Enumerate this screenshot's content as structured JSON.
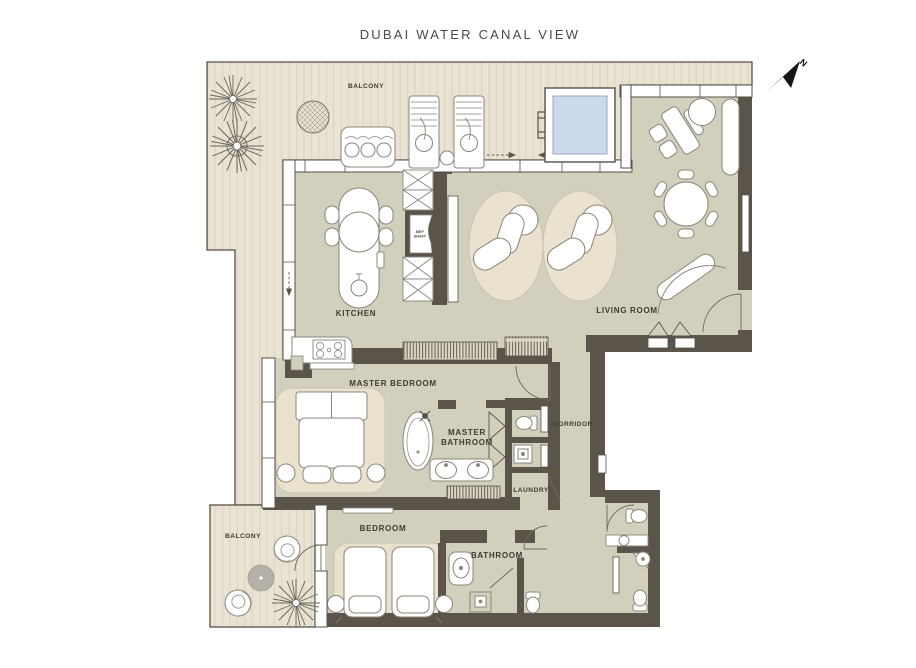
{
  "header": {
    "title": "DUBAI WATER CANAL VIEW"
  },
  "compass": {
    "n": "N"
  },
  "rooms": {
    "balcony_top": "BALCONY",
    "balcony_bottom": "BALCONY",
    "kitchen": "KITCHEN",
    "living_room": "LIVING ROOM",
    "master_bedroom": "MASTER BEDROOM",
    "master_bathroom_line1": "MASTER",
    "master_bathroom_line2": "BATHROOM",
    "corridor": "CORRIDOR",
    "laundry": "LAUNDRY",
    "bedroom": "BEDROOM",
    "bathroom": "BATHROOM",
    "mep_shaft_line1": "MEP",
    "mep_shaft_line2": "SHAFT"
  },
  "colors": {
    "wall": "#5b544b",
    "interior_floor": "#d2cfbc",
    "deck_floor": "#eae3d3",
    "deck_stripe": "#dcd4c1",
    "rug": "#eae2cf",
    "pool_water": "#ccd9ed",
    "label_text": "#3f3b35",
    "background": "#ffffff"
  }
}
